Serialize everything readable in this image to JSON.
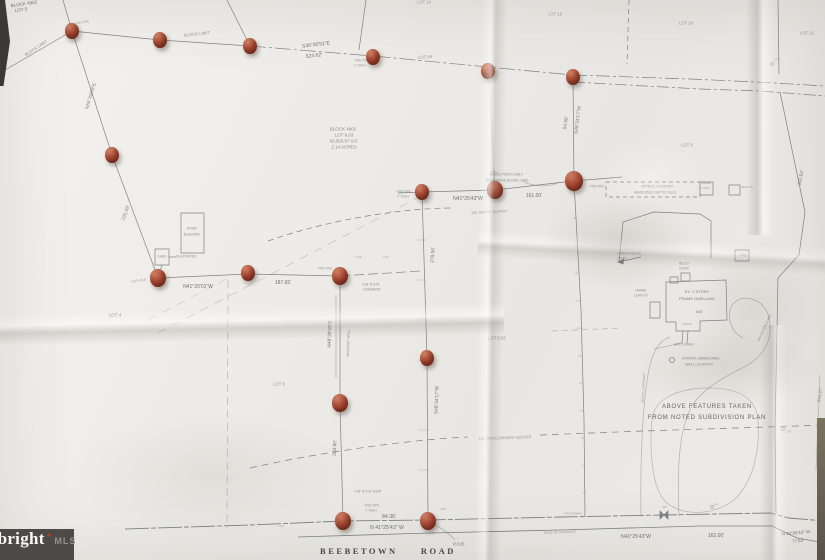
{
  "watermark": {
    "brand": "bright",
    "star": "✦",
    "suffix": "MLS"
  },
  "road_name": "BEEBETOWN ROAD",
  "colors": {
    "paper": "#edebe7",
    "ink": "#4e5257",
    "pin": "#ad4d38",
    "watermark_bg": "#4d4a47",
    "watermark_star": "#c0392b"
  },
  "labels": [
    {
      "t": "BLOCK 4902",
      "x": 24,
      "y": 4,
      "fs": 4.5,
      "r": -8
    },
    {
      "t": "LOT 5",
      "x": 21,
      "y": 10,
      "fs": 4.5,
      "r": -8
    },
    {
      "t": "FND PIPE",
      "x": 82,
      "y": 23,
      "fs": 3.2,
      "r": -8,
      "o": 0.5
    },
    {
      "t": "BLOCK LIMIT",
      "x": 36,
      "y": 48,
      "fs": 4.2,
      "r": -33,
      "o": 0.6
    },
    {
      "t": "BLOCK LIMIT",
      "x": 197,
      "y": 34,
      "fs": 4.2,
      "r": -6,
      "o": 0.6
    },
    {
      "t": "N56°49'09\"E",
      "x": 91,
      "y": 96,
      "fs": 4.8,
      "r": -73,
      "o": 0.7
    },
    {
      "t": "225.09'",
      "x": 126,
      "y": 213,
      "fs": 4.8,
      "r": -70,
      "o": 0.7
    },
    {
      "t": "S36°30'51\"E",
      "x": 316,
      "y": 45,
      "fs": 5,
      "r": -7
    },
    {
      "t": "524.62'",
      "x": 314,
      "y": 56,
      "fs": 5,
      "r": -7
    },
    {
      "t": "LOT 14",
      "x": 424,
      "y": 2,
      "fs": 4.2,
      "o": 0.5
    },
    {
      "t": "LOT 59",
      "x": 425,
      "y": 57,
      "fs": 4.2,
      "r": -4,
      "o": 0.6
    },
    {
      "t": "LOT 19",
      "x": 555,
      "y": 14,
      "fs": 4.2,
      "o": 0.5
    },
    {
      "t": "LOT 20",
      "x": 686,
      "y": 23,
      "fs": 4.2,
      "o": 0.55
    },
    {
      "t": "LOT 21",
      "x": 807,
      "y": 33,
      "fs": 4.2,
      "o": 0.55
    },
    {
      "t": "FND PIPE",
      "x": 362,
      "y": 61,
      "fs": 3.2,
      "o": 0.55
    },
    {
      "t": "2' HIGH",
      "x": 360,
      "y": 66,
      "fs": 3.2,
      "o": 0.55
    },
    {
      "t": "BLOCK 4901",
      "x": 343,
      "y": 129,
      "fs": 4.5,
      "o": 0.65
    },
    {
      "t": "LOT 6.03",
      "x": 344,
      "y": 135,
      "fs": 4.5,
      "o": 0.65
    },
    {
      "t": "93,303.97 S.F.",
      "x": 344,
      "y": 141,
      "fs": 4.5,
      "o": 0.65
    },
    {
      "t": "2.14 ACRES",
      "x": 344,
      "y": 147,
      "fs": 4.5,
      "o": 0.65
    },
    {
      "t": "94.98'",
      "x": 566,
      "y": 123,
      "fs": 4.8,
      "r": -83,
      "o": 0.7
    },
    {
      "t": "S48°34'17\"W",
      "x": 578,
      "y": 120,
      "fs": 4.8,
      "r": -83,
      "o": 0.7
    },
    {
      "t": "LOT 6",
      "x": 687,
      "y": 145,
      "fs": 4.2,
      "o": 0.55
    },
    {
      "t": "342.94'",
      "x": 801,
      "y": 178,
      "fs": 4.8,
      "r": -78,
      "o": 0.7
    },
    {
      "t": "U.P.",
      "x": 777,
      "y": 60,
      "fs": 3,
      "o": 0.5
    },
    {
      "t": "APPROX. LOCATION",
      "x": 657,
      "y": 187,
      "fs": 3.2,
      "o": 0.6
    },
    {
      "t": "ABANDONED SEPTIC FIELD",
      "x": 655,
      "y": 193,
      "fs": 3.2,
      "o": 0.6
    },
    {
      "t": "FENCE POSTS ONLY",
      "x": 506,
      "y": 175,
      "fs": 3.4,
      "o": 0.65
    },
    {
      "t": "(MEANDERS ALONG LINE)",
      "x": 507,
      "y": 181,
      "fs": 3.4,
      "o": 0.65
    },
    {
      "t": "N41°25'43\"W",
      "x": 468,
      "y": 199,
      "fs": 5
    },
    {
      "t": "161.00'",
      "x": 534,
      "y": 196,
      "fs": 5
    },
    {
      "t": "FND PIPE",
      "x": 404,
      "y": 192,
      "fs": 3.2,
      "o": 0.55
    },
    {
      "t": "2' HIGH",
      "x": 403,
      "y": 197,
      "fs": 3.2,
      "o": 0.55
    },
    {
      "t": "FND PIPE",
      "x": 597,
      "y": 187,
      "fs": 3.2,
      "o": 0.55
    },
    {
      "t": "100' SEPTIC BUFFER",
      "x": 489,
      "y": 212,
      "fs": 3.6,
      "r": -3,
      "o": 0.55
    },
    {
      "t": "7' WIRE FENCE",
      "x": 629,
      "y": 254,
      "fs": 3.4,
      "o": 0.6
    },
    {
      "t": "(TYP.)",
      "x": 622,
      "y": 259,
      "fs": 3.4,
      "o": 0.6
    },
    {
      "t": "SHED",
      "x": 744,
      "y": 256,
      "fs": 3.2,
      "o": 0.55
    },
    {
      "t": "BILCO",
      "x": 684,
      "y": 264,
      "fs": 3.2,
      "o": 0.6
    },
    {
      "t": "DOOR",
      "x": 684,
      "y": 269,
      "fs": 3.2,
      "o": 0.6
    },
    {
      "t": "EX. 2 STORY",
      "x": 697,
      "y": 292,
      "fs": 4,
      "o": 0.7
    },
    {
      "t": "FRAME DWELLING",
      "x": 697,
      "y": 299,
      "fs": 4,
      "o": 0.7
    },
    {
      "t": "#45",
      "x": 699,
      "y": 312,
      "fs": 4,
      "o": 0.7
    },
    {
      "t": "FRAME",
      "x": 641,
      "y": 291,
      "fs": 3.2,
      "o": 0.6
    },
    {
      "t": "LEAN-TO",
      "x": 641,
      "y": 296,
      "fs": 3.2,
      "o": 0.6
    },
    {
      "t": "PORCH",
      "x": 687,
      "y": 325,
      "fs": 2.8,
      "o": 0.5
    },
    {
      "t": "BRICK WALK",
      "x": 684,
      "y": 345,
      "fs": 3.2,
      "o": 0.6
    },
    {
      "t": "APPROX. ABANDONED",
      "x": 701,
      "y": 359,
      "fs": 3.4,
      "o": 0.65
    },
    {
      "t": "WELL LOCATION",
      "x": 699,
      "y": 365,
      "fs": 3.4,
      "o": 0.65
    },
    {
      "t": "GRAVEL DRIVEWAY",
      "x": 765,
      "y": 328,
      "fs": 3.2,
      "r": -65,
      "o": 0.55
    },
    {
      "t": "GRAVEL DRIVEWAY",
      "x": 644,
      "y": 388,
      "fs": 3.2,
      "r": -87,
      "o": 0.5
    },
    {
      "t": "FRAME",
      "x": 706,
      "y": 184,
      "fs": 2.8,
      "o": 0.5
    },
    {
      "t": "COOP",
      "x": 706,
      "y": 189,
      "fs": 2.8,
      "o": 0.5
    },
    {
      "t": "LEAN-TO",
      "x": 747,
      "y": 188,
      "fs": 2.8,
      "o": 0.5
    },
    {
      "t": "EXIST",
      "x": 192,
      "y": 229,
      "fs": 3.4,
      "o": 0.65
    },
    {
      "t": "BUILDING",
      "x": 192,
      "y": 235,
      "fs": 3.4,
      "o": 0.65
    },
    {
      "t": "SHED",
      "x": 162,
      "y": 257,
      "fs": 3.2,
      "o": 0.6
    },
    {
      "t": "DILAPIDATED",
      "x": 186,
      "y": 257,
      "fs": 3.2,
      "o": 0.6
    },
    {
      "t": "NOT HELD",
      "x": 139,
      "y": 281,
      "fs": 3,
      "r": -10,
      "o": 0.5
    },
    {
      "t": "N41°20'01\"W",
      "x": 198,
      "y": 287,
      "fs": 5
    },
    {
      "t": "187.65'",
      "x": 283,
      "y": 283,
      "fs": 5
    },
    {
      "t": "FND PIPE",
      "x": 325,
      "y": 269,
      "fs": 3.2,
      "o": 0.55
    },
    {
      "t": "5.06'",
      "x": 359,
      "y": 258,
      "fs": 2.8,
      "o": 0.5
    },
    {
      "t": "3.67'",
      "x": 386,
      "y": 258,
      "fs": 2.8,
      "o": 0.5
    },
    {
      "t": "4.36' R.O.W.",
      "x": 371,
      "y": 285,
      "fs": 3.2,
      "o": 0.6
    },
    {
      "t": "EASEMENT",
      "x": 372,
      "y": 290,
      "fs": 3.2,
      "o": 0.6
    },
    {
      "t": "N48°39'59\"E",
      "x": 330,
      "y": 334,
      "fs": 4.8,
      "r": -88,
      "o": 0.75
    },
    {
      "t": "MASONRY WALL",
      "x": 349,
      "y": 343,
      "fs": 3.4,
      "r": -88,
      "o": 0.6
    },
    {
      "t": "270.56'",
      "x": 433,
      "y": 255,
      "fs": 4.8,
      "r": -86,
      "o": 0.8
    },
    {
      "t": "LOT 6.02",
      "x": 497,
      "y": 338,
      "fs": 4.2,
      "o": 0.6
    },
    {
      "t": "LOT 4",
      "x": 115,
      "y": 315,
      "fs": 4.5,
      "o": 0.7
    },
    {
      "t": "LOT 5",
      "x": 279,
      "y": 384,
      "fs": 4.2,
      "o": 0.6
    },
    {
      "t": "203.86'",
      "x": 335,
      "y": 448,
      "fs": 4.8,
      "r": -87,
      "o": 0.75
    },
    {
      "t": "S48°34'17\"W",
      "x": 437,
      "y": 400,
      "fs": 4.8,
      "r": -88,
      "o": 0.75
    },
    {
      "t": "110' DEVELOPMENT BUFFER",
      "x": 505,
      "y": 438,
      "fs": 3.8,
      "r": -2,
      "o": 0.55
    },
    {
      "t": "4.36' R.O.W. ESMT",
      "x": 368,
      "y": 492,
      "fs": 3.2,
      "o": 0.6
    },
    {
      "t": "FND PIPE",
      "x": 372,
      "y": 506,
      "fs": 3.2,
      "o": 0.55
    },
    {
      "t": "2' HIGH",
      "x": 371,
      "y": 511,
      "fs": 3.2,
      "o": 0.55
    },
    {
      "t": "84.36'",
      "x": 389,
      "y": 517,
      "fs": 5.2
    },
    {
      "t": "N 41°25'43\" W",
      "x": 387,
      "y": 528,
      "fs": 5.2
    },
    {
      "t": "P.O.B.",
      "x": 459,
      "y": 544,
      "fs": 4.2,
      "i": 1
    },
    {
      "t": "BEEBETOWN  ROAD",
      "x": 388,
      "y": 551,
      "fs": 8.5,
      "cls": "road"
    },
    {
      "t": "EDGE OF PAVEMENT",
      "x": 560,
      "y": 533,
      "fs": 3.2,
      "r": -2,
      "o": 0.5
    },
    {
      "t": "FND REBAR",
      "x": 573,
      "y": 514,
      "fs": 3,
      "o": 0.5
    },
    {
      "t": "WV",
      "x": 665,
      "y": 508,
      "fs": 2.8,
      "o": 0.55
    },
    {
      "t": "N41°25'43\"W",
      "x": 636,
      "y": 537,
      "fs": 5
    },
    {
      "t": "162.00'",
      "x": 716,
      "y": 536,
      "fs": 5
    },
    {
      "t": "N 43°09'10\" W",
      "x": 796,
      "y": 533,
      "fs": 4.4,
      "r": -5
    },
    {
      "t": "77.64'",
      "x": 798,
      "y": 541,
      "fs": 4.4,
      "r": -5
    },
    {
      "t": "ABOVE FEATURES TAKEN",
      "x": 707,
      "y": 406,
      "fs": 6,
      "cls": "note"
    },
    {
      "t": "FROM NOTED SUBDIVISION PLAN",
      "x": 707,
      "y": 417,
      "fs": 6,
      "cls": "note"
    },
    {
      "t": "U.P.",
      "x": 789,
      "y": 432,
      "fs": 3,
      "o": 0.5
    },
    {
      "t": "U.P.",
      "x": 716,
      "y": 505,
      "fs": 3,
      "o": 0.5
    },
    {
      "t": "344.37'",
      "x": 820,
      "y": 395,
      "fs": 4.4,
      "r": -80,
      "o": 0.6
    },
    {
      "t": "FND",
      "x": 443,
      "y": 510,
      "fs": 2.8,
      "o": 0.45
    },
    {
      "t": "FND",
      "x": 281,
      "y": 527,
      "fs": 2.8,
      "o": 0.45
    }
  ],
  "pins": [
    {
      "x": 72,
      "y": 31
    },
    {
      "x": 160,
      "y": 40
    },
    {
      "x": 250,
      "y": 46
    },
    {
      "x": 373,
      "y": 57
    },
    {
      "x": 488,
      "y": 71
    },
    {
      "x": 573,
      "y": 77
    },
    {
      "x": 574,
      "y": 181,
      "s": 1.25
    },
    {
      "x": 112,
      "y": 155
    },
    {
      "x": 158,
      "y": 278,
      "s": 1.1
    },
    {
      "x": 248,
      "y": 273
    },
    {
      "x": 340,
      "y": 276,
      "s": 1.15
    },
    {
      "x": 422,
      "y": 192
    },
    {
      "x": 495,
      "y": 190,
      "s": 1.1
    },
    {
      "x": 427,
      "y": 358
    },
    {
      "x": 340,
      "y": 403,
      "s": 1.1
    },
    {
      "x": 343,
      "y": 521,
      "s": 1.1
    },
    {
      "x": 428,
      "y": 521,
      "s": 1.15
    }
  ]
}
